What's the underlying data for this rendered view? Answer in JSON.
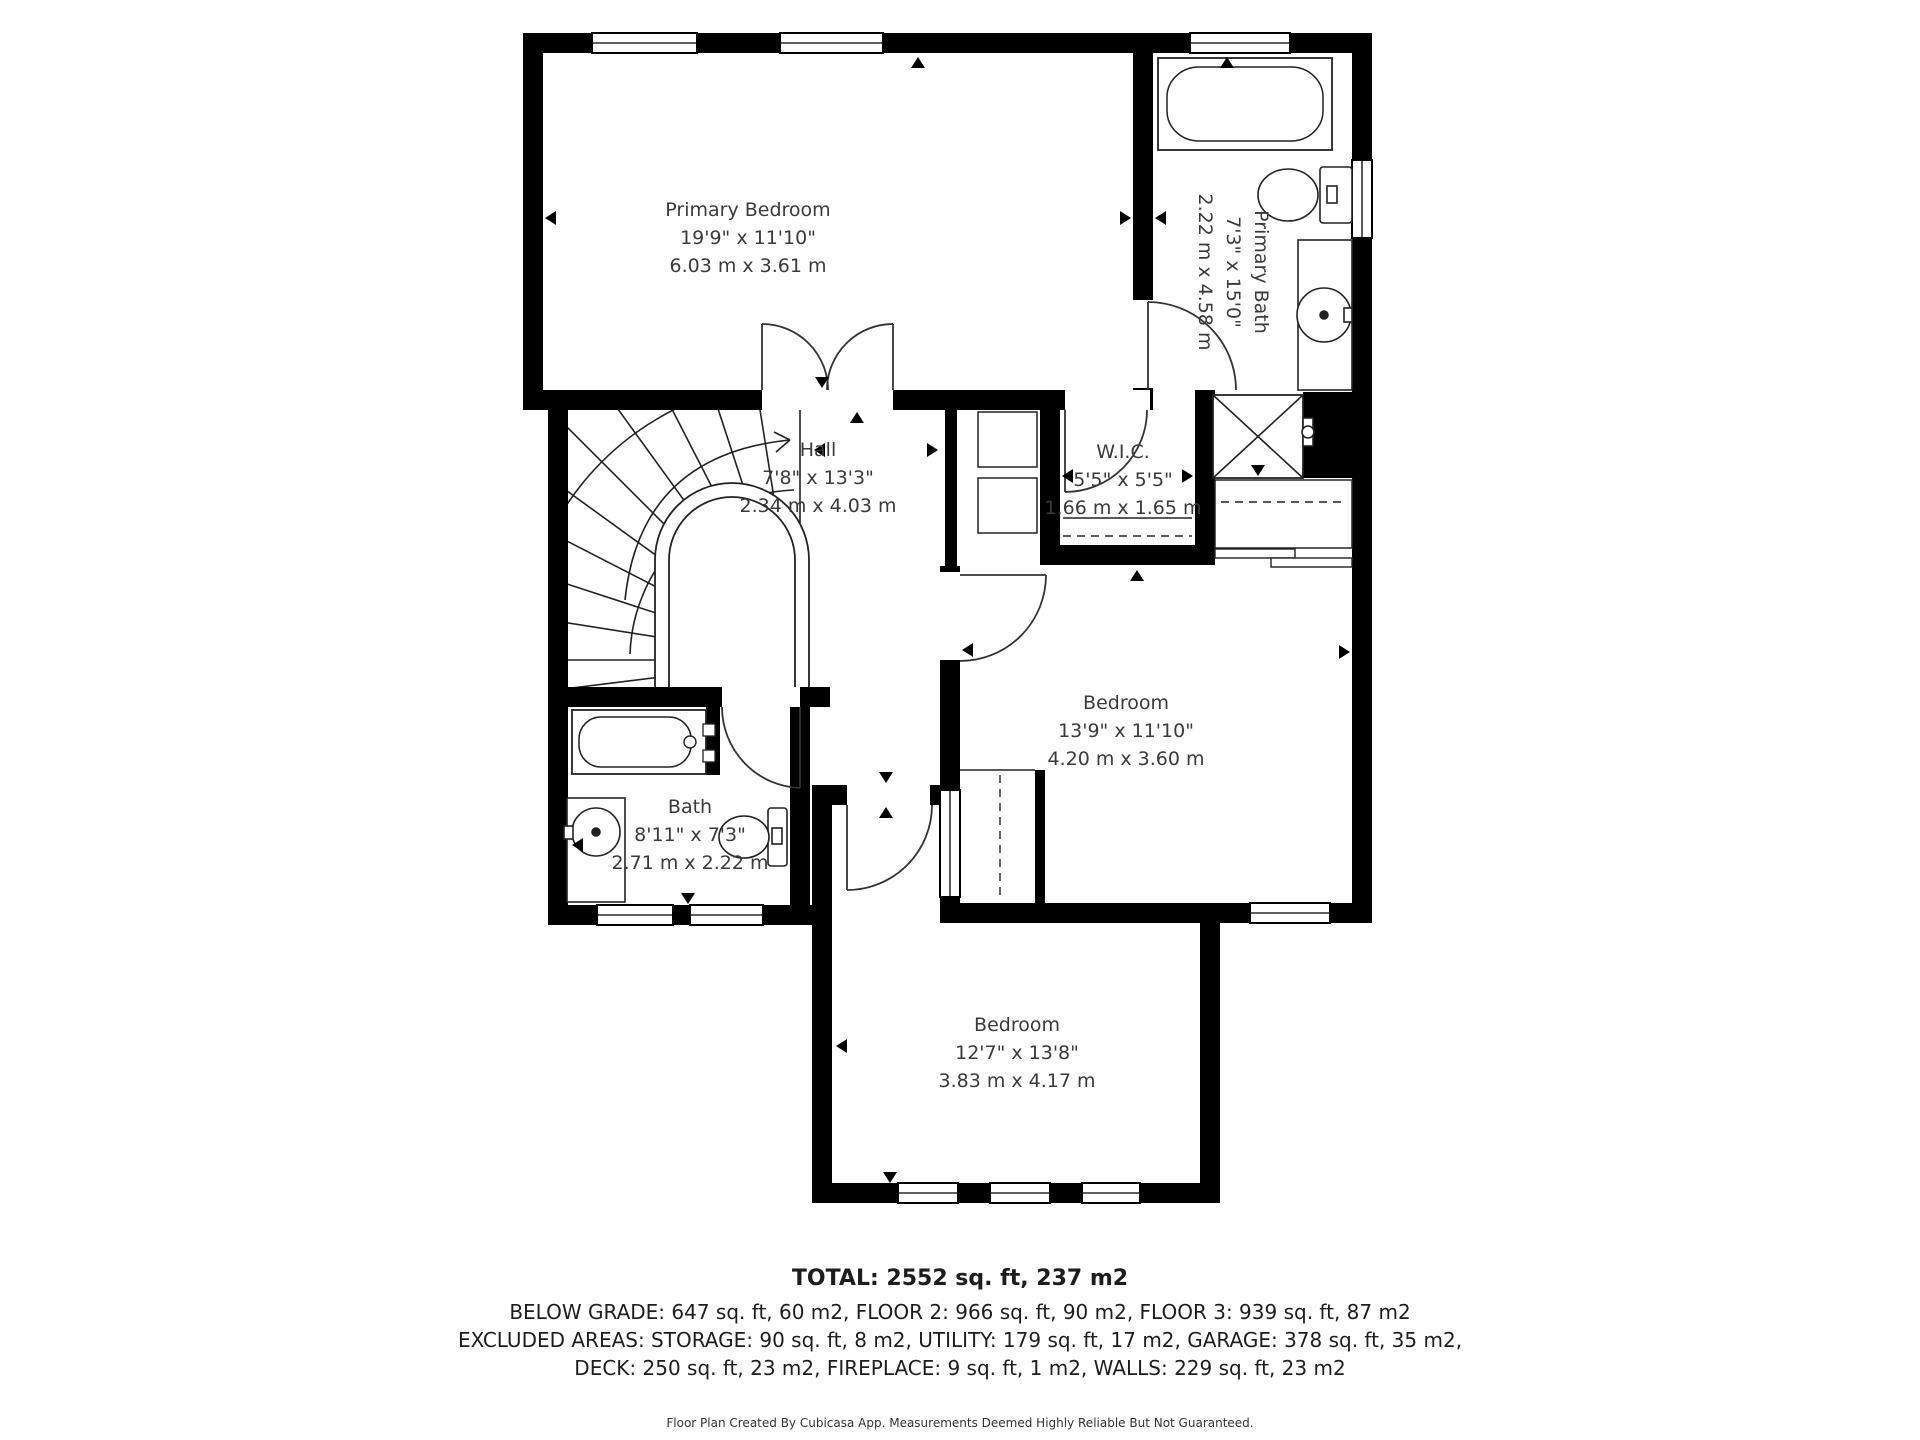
{
  "floor_plan": {
    "rooms": [
      {
        "id": "primary-bedroom",
        "name": "Primary Bedroom",
        "imperial": "19'9\" x 11'10\"",
        "metric": "6.03 m x 3.61 m"
      },
      {
        "id": "primary-bath",
        "name": "Primary Bath",
        "imperial": "7'3\" x 15'0\"",
        "metric": "2.22 m x 4.58 m"
      },
      {
        "id": "hall",
        "name": "Hall",
        "imperial": "7'8\" x 13'3\"",
        "metric": "2.34 m x 4.03 m"
      },
      {
        "id": "wic",
        "name": "W.I.C.",
        "imperial": "5'5\" x 5'5\"",
        "metric": "1.66 m x 1.65 m"
      },
      {
        "id": "bedroom-right",
        "name": "Bedroom",
        "imperial": "13'9\" x 11'10\"",
        "metric": "4.20 m x 3.60 m"
      },
      {
        "id": "bath",
        "name": "Bath",
        "imperial": "8'11\" x 7'3\"",
        "metric": "2.71 m x 2.22 m"
      },
      {
        "id": "bedroom-bottom",
        "name": "Bedroom",
        "imperial": "12'7\" x 13'8\"",
        "metric": "3.83 m x 4.17 m"
      }
    ],
    "summary": {
      "total": "TOTAL: 2552 sq. ft, 237 m2",
      "line2": "BELOW GRADE: 647 sq. ft, 60 m2, FLOOR 2: 966 sq. ft, 90 m2, FLOOR 3: 939 sq. ft, 87 m2",
      "line3": "EXCLUDED AREAS: STORAGE: 90 sq. ft, 8 m2, UTILITY: 179 sq. ft, 17 m2, GARAGE: 378 sq. ft, 35 m2,",
      "line4": "DECK: 250 sq. ft, 23 m2, FIREPLACE: 9 sq. ft, 1 m2, WALLS: 229 sq. ft, 23 m2",
      "disclaimer": "Floor Plan Created By Cubicasa App. Measurements Deemed Highly Reliable But Not Guaranteed."
    },
    "colors": {
      "wall": "#000000",
      "label_text": "#3a3a3a"
    }
  }
}
